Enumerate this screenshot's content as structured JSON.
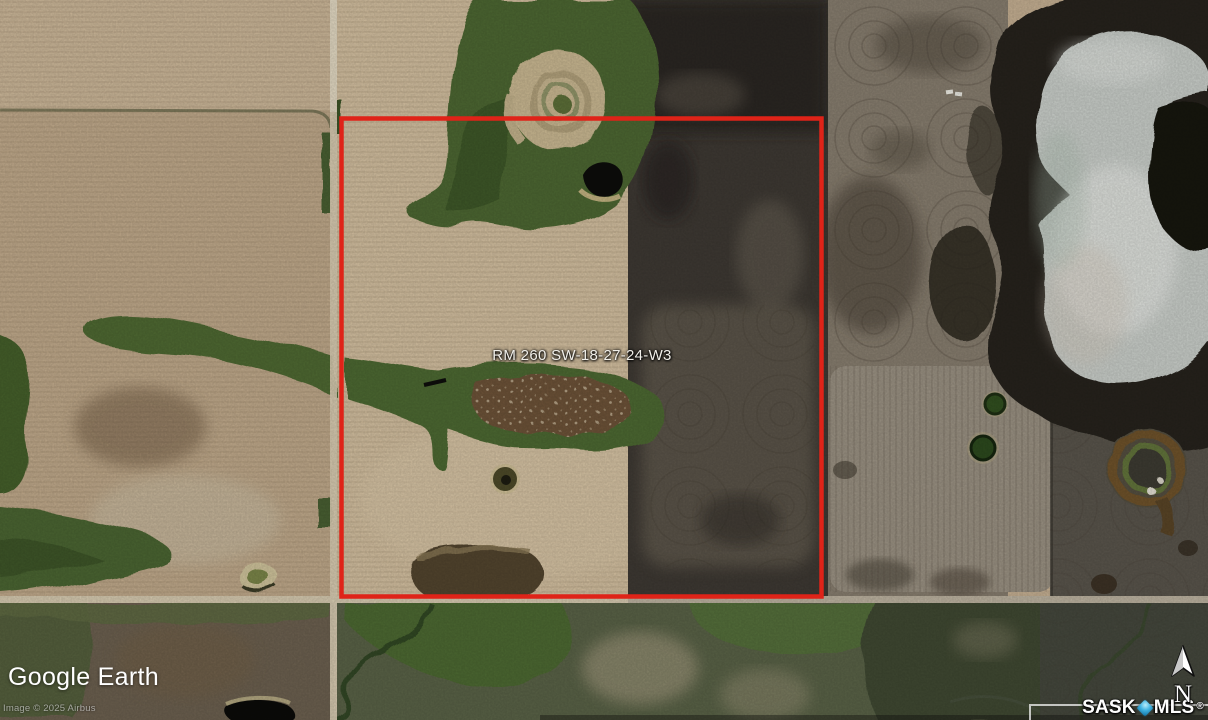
{
  "map": {
    "parcel_label": "RM 260 SW-18-27-24-W3",
    "boundary_color": "#df2318"
  },
  "branding": {
    "google_earth_logo": "Google Earth",
    "imagery_credit": "Image © 2025 Airbus",
    "mls_wordmark_left": "SASK",
    "mls_wordmark_right": "MLS",
    "mls_registered_mark": "®",
    "mls_diamond_color": "#2fa8d8"
  },
  "compass": {
    "north_label": "N"
  }
}
